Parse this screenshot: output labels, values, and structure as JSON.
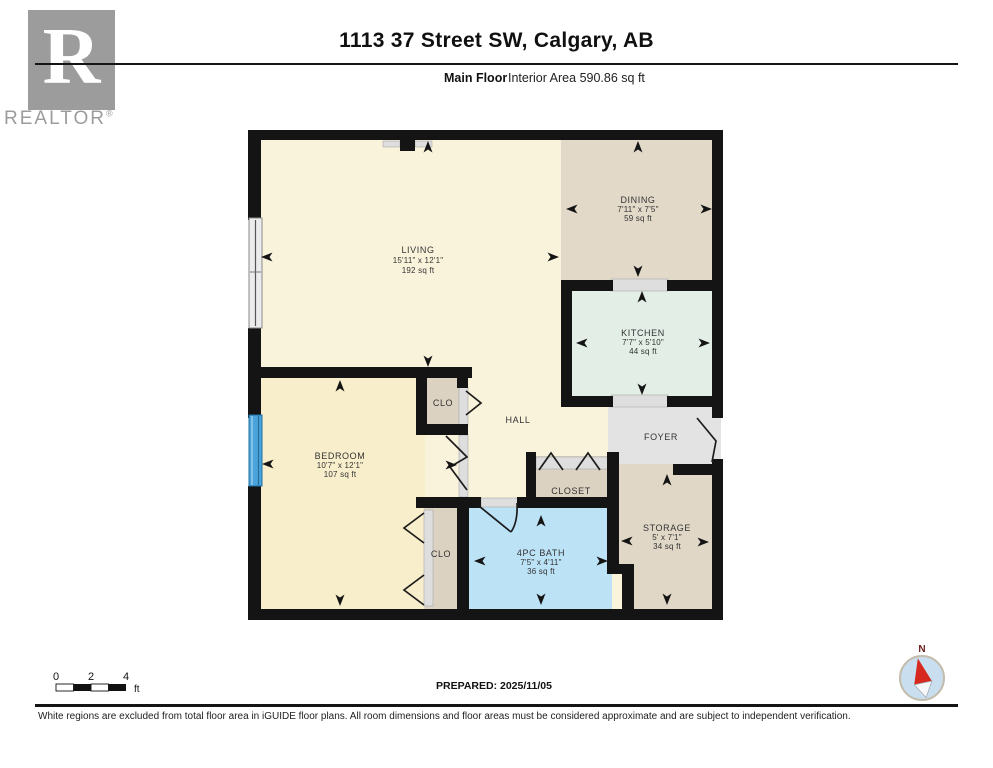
{
  "header": {
    "title": "1113 37 Street SW, Calgary, AB",
    "floor_label": "Main Floor",
    "area_label": "Interior Area 590.86 sq ft"
  },
  "logo": {
    "letter": "R",
    "brand": "REALTOR",
    "registered": "®"
  },
  "rooms": {
    "living": {
      "name": "LIVING",
      "dims": "15'11\" x 12'1\"",
      "area": "192 sq ft"
    },
    "dining": {
      "name": "DINING",
      "dims": "7'11\" x 7'5\"",
      "area": "59 sq ft"
    },
    "kitchen": {
      "name": "KITCHEN",
      "dims": "7'7\" x 5'10\"",
      "area": "44 sq ft"
    },
    "bedroom": {
      "name": "BEDROOM",
      "dims": "10'7\" x 12'1\"",
      "area": "107 sq ft"
    },
    "bath": {
      "name": "4PC BATH",
      "dims": "7'5\" x 4'11\"",
      "area": "36 sq ft"
    },
    "storage": {
      "name": "STORAGE",
      "dims": "5' x 7'1\"",
      "area": "34 sq ft"
    },
    "hall": {
      "name": "HALL"
    },
    "foyer": {
      "name": "FOYER"
    },
    "closet": {
      "name": "CLOSET"
    },
    "clo_top": {
      "name": "CLO"
    },
    "clo_bottom": {
      "name": "CLO"
    }
  },
  "scale_bar": {
    "tick_0": "0",
    "tick_2": "2",
    "tick_4": "4",
    "unit": "ft"
  },
  "prepared_label": "PREPARED: 2025/11/05",
  "compass": {
    "north_label": "N"
  },
  "footer": {
    "disclaimer": "White regions are excluded from total floor area in iGUIDE floor plans. All room dimensions and floor areas must be considered approximate and are subject to independent verification."
  },
  "colors": {
    "living": "#FAF3DC",
    "bedroom": "#F9EECB",
    "dining": "#E2D9C9",
    "kitchen": "#E3EEE7",
    "bath": "#BCE2F6",
    "foyer": "#E3E3E3",
    "closet": "#DCD2C2",
    "storage": "#E0D7C7",
    "wall": "#141414",
    "window_blue": "#4AA3DB"
  }
}
